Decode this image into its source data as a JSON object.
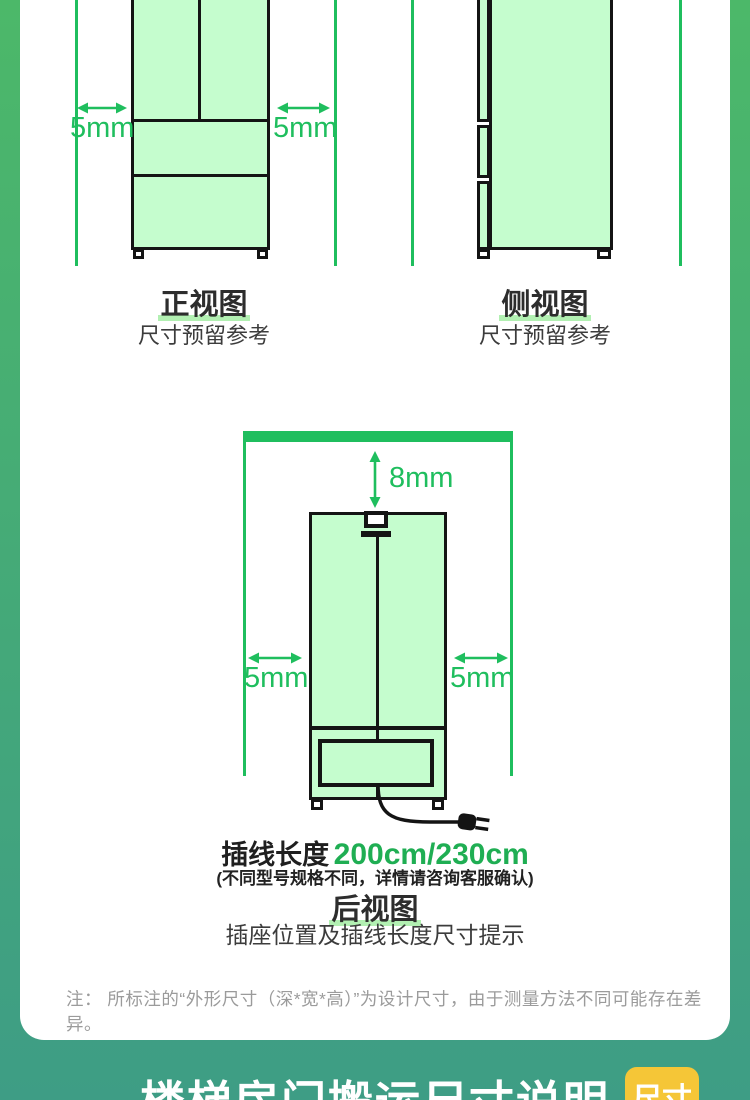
{
  "colors": {
    "accent_green": "#1fbe5e",
    "mint_fill": "#c5fdce",
    "outline_black": "#141414",
    "teal_background": "#3e9d85",
    "gradient_top": "#4cb869",
    "badge_yellow": "#f5c637",
    "highlight_underline": "#b2f0b2"
  },
  "front_view": {
    "left_clearance": "5mm",
    "right_clearance": "5mm",
    "title": "正视图",
    "subtitle": "尺寸预留参考"
  },
  "side_view": {
    "title": "侧视图",
    "subtitle": "尺寸预留参考"
  },
  "back_view": {
    "top_clearance": "8mm",
    "left_clearance": "5mm",
    "right_clearance": "5mm",
    "cord_label": "插线长度",
    "cord_value": "200cm/230cm",
    "cord_note": "(不同型号规格不同，详情请咨询客服确认)",
    "title": "后视图",
    "subtitle": "插座位置及插线长度尺寸提示"
  },
  "note": "注： 所标注的“外形尺寸（深*宽*高）”为设计尺寸，由于测量方法不同可能存在差异。",
  "footer": {
    "title": "楼梯房门搬运尺寸说明",
    "badge_label": "尺寸"
  }
}
